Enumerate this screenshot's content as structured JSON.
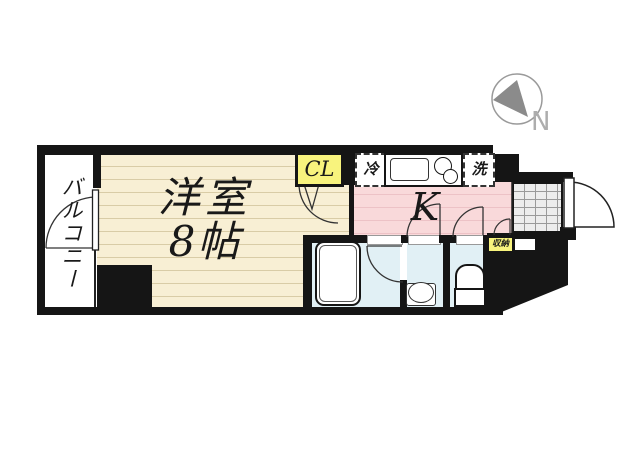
{
  "plan": {
    "balcony": "バルコニー",
    "main_room_name": "洋室",
    "main_room_size": "8帖",
    "kitchen": "K",
    "closet": "CL",
    "refrigerator": "冷",
    "washing_machine": "洗",
    "storage": "収納",
    "compass_north": "N"
  },
  "colors": {
    "wall": "#151515",
    "room_floor": "#f8efd4",
    "room_floor_line": "#d9cca6",
    "kitchen_floor": "#f9d9da",
    "kitchen_floor_line": "#edc2c6",
    "wet_room_floor": "#e1f0f5",
    "label_bg": "#f8f37d",
    "entrance_tile_bg": "#ededed",
    "entrance_tile_line": "#9a9a9a",
    "compass_needle": "#8b8b8b"
  }
}
